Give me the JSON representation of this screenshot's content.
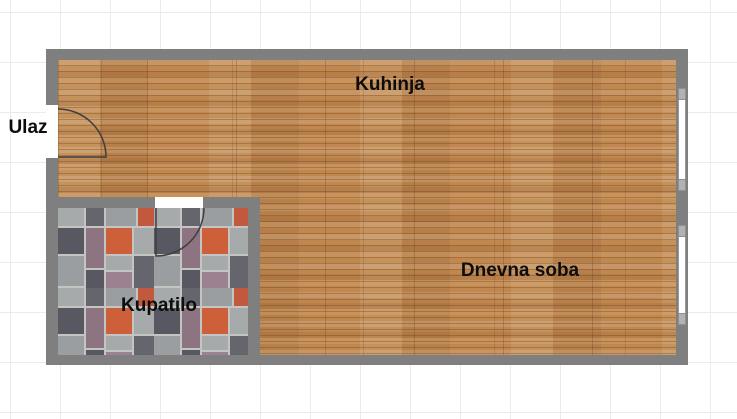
{
  "floorplan": {
    "labels": {
      "entrance": "Ulaz",
      "kitchen": "Kuhinja",
      "living_room": "Dnevna soba",
      "bathroom": "Kupatilo"
    },
    "rooms": [
      {
        "name": "Kuhinja",
        "floor": "wood"
      },
      {
        "name": "Dnevna soba",
        "floor": "wood"
      },
      {
        "name": "Kupatilo",
        "floor": "tile"
      },
      {
        "name": "Ulaz",
        "floor": "none"
      }
    ],
    "features": {
      "windows_right_wall": 2,
      "doors": [
        "entrance-door-swing",
        "bathroom-door-swing"
      ]
    }
  },
  "colors": {
    "wall": "#7f7f7f",
    "grid_line": "#ebebeb",
    "wood_base": "#c0874f",
    "tile_grout": "#c4c4c0",
    "tile_light": "#a7aaab",
    "tile_light2": "#9b9ea0",
    "tile_dark": "#575861",
    "tile_dark2": "#64656d",
    "tile_mauve": "#8e7380",
    "tile_mauve2": "#9c8190",
    "tile_orange": "#cd5f3a",
    "tile_orange2": "#c2593f",
    "door_arc": "#3f3f3f",
    "window_frame": "#9a9a9a",
    "window_fill": "#ffffff",
    "label_text": "#0d0d0d"
  }
}
